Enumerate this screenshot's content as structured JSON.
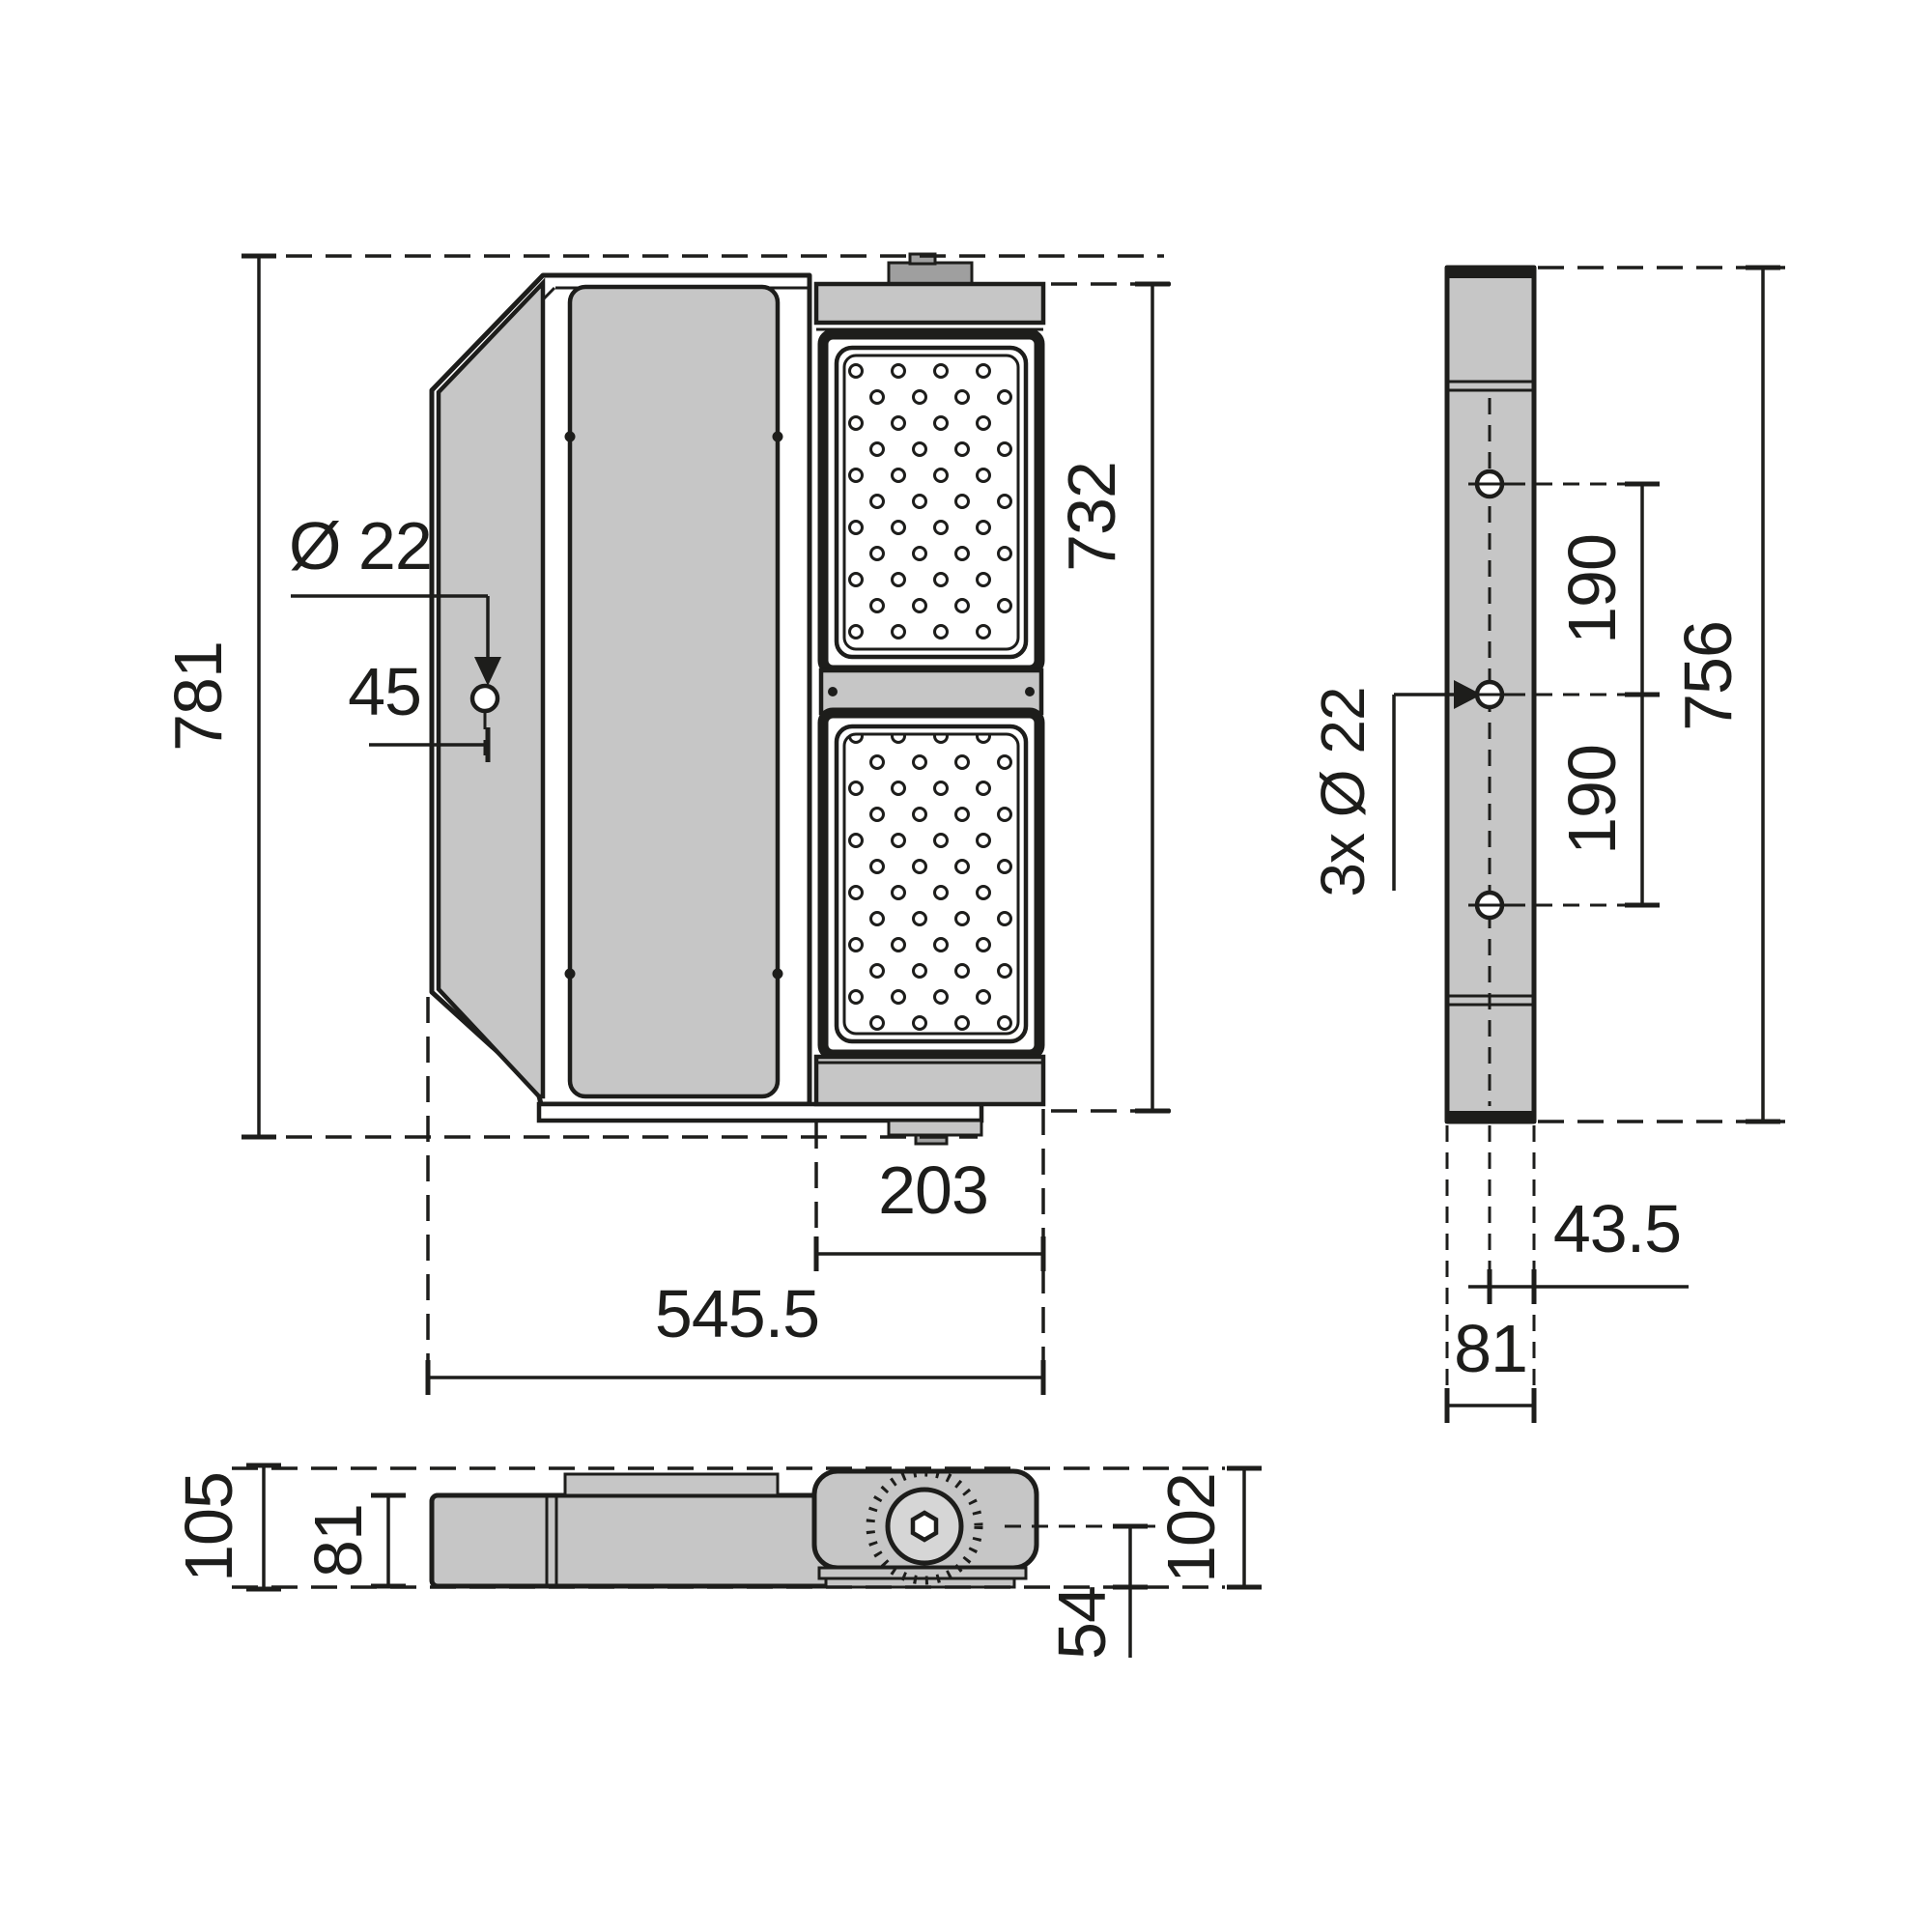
{
  "drawing_type": "luminaire-dimension-drawing",
  "colors": {
    "line": "#1d1d1b",
    "body_gray": "#c6c6c6",
    "tab_gray": "#9f9f9f",
    "background": "#ffffff"
  },
  "front_view": {
    "overall_height": "781",
    "led_section_height": "732",
    "overall_width": "545.5",
    "led_section_width": "203",
    "mounting_hole_diameter": "Ø 22",
    "mounting_hole_offset": "45"
  },
  "side_view": {
    "bracket_height": "756",
    "upper_hole_spacing": "190",
    "lower_hole_spacing": "190",
    "mounting_holes_label": "3x Ø 22",
    "hole_center_to_edge": "43.5",
    "profile_width": "81"
  },
  "top_view": {
    "overall_depth": "105",
    "housing_depth": "81",
    "pivot_to_bottom": "54",
    "head_depth": "102"
  }
}
